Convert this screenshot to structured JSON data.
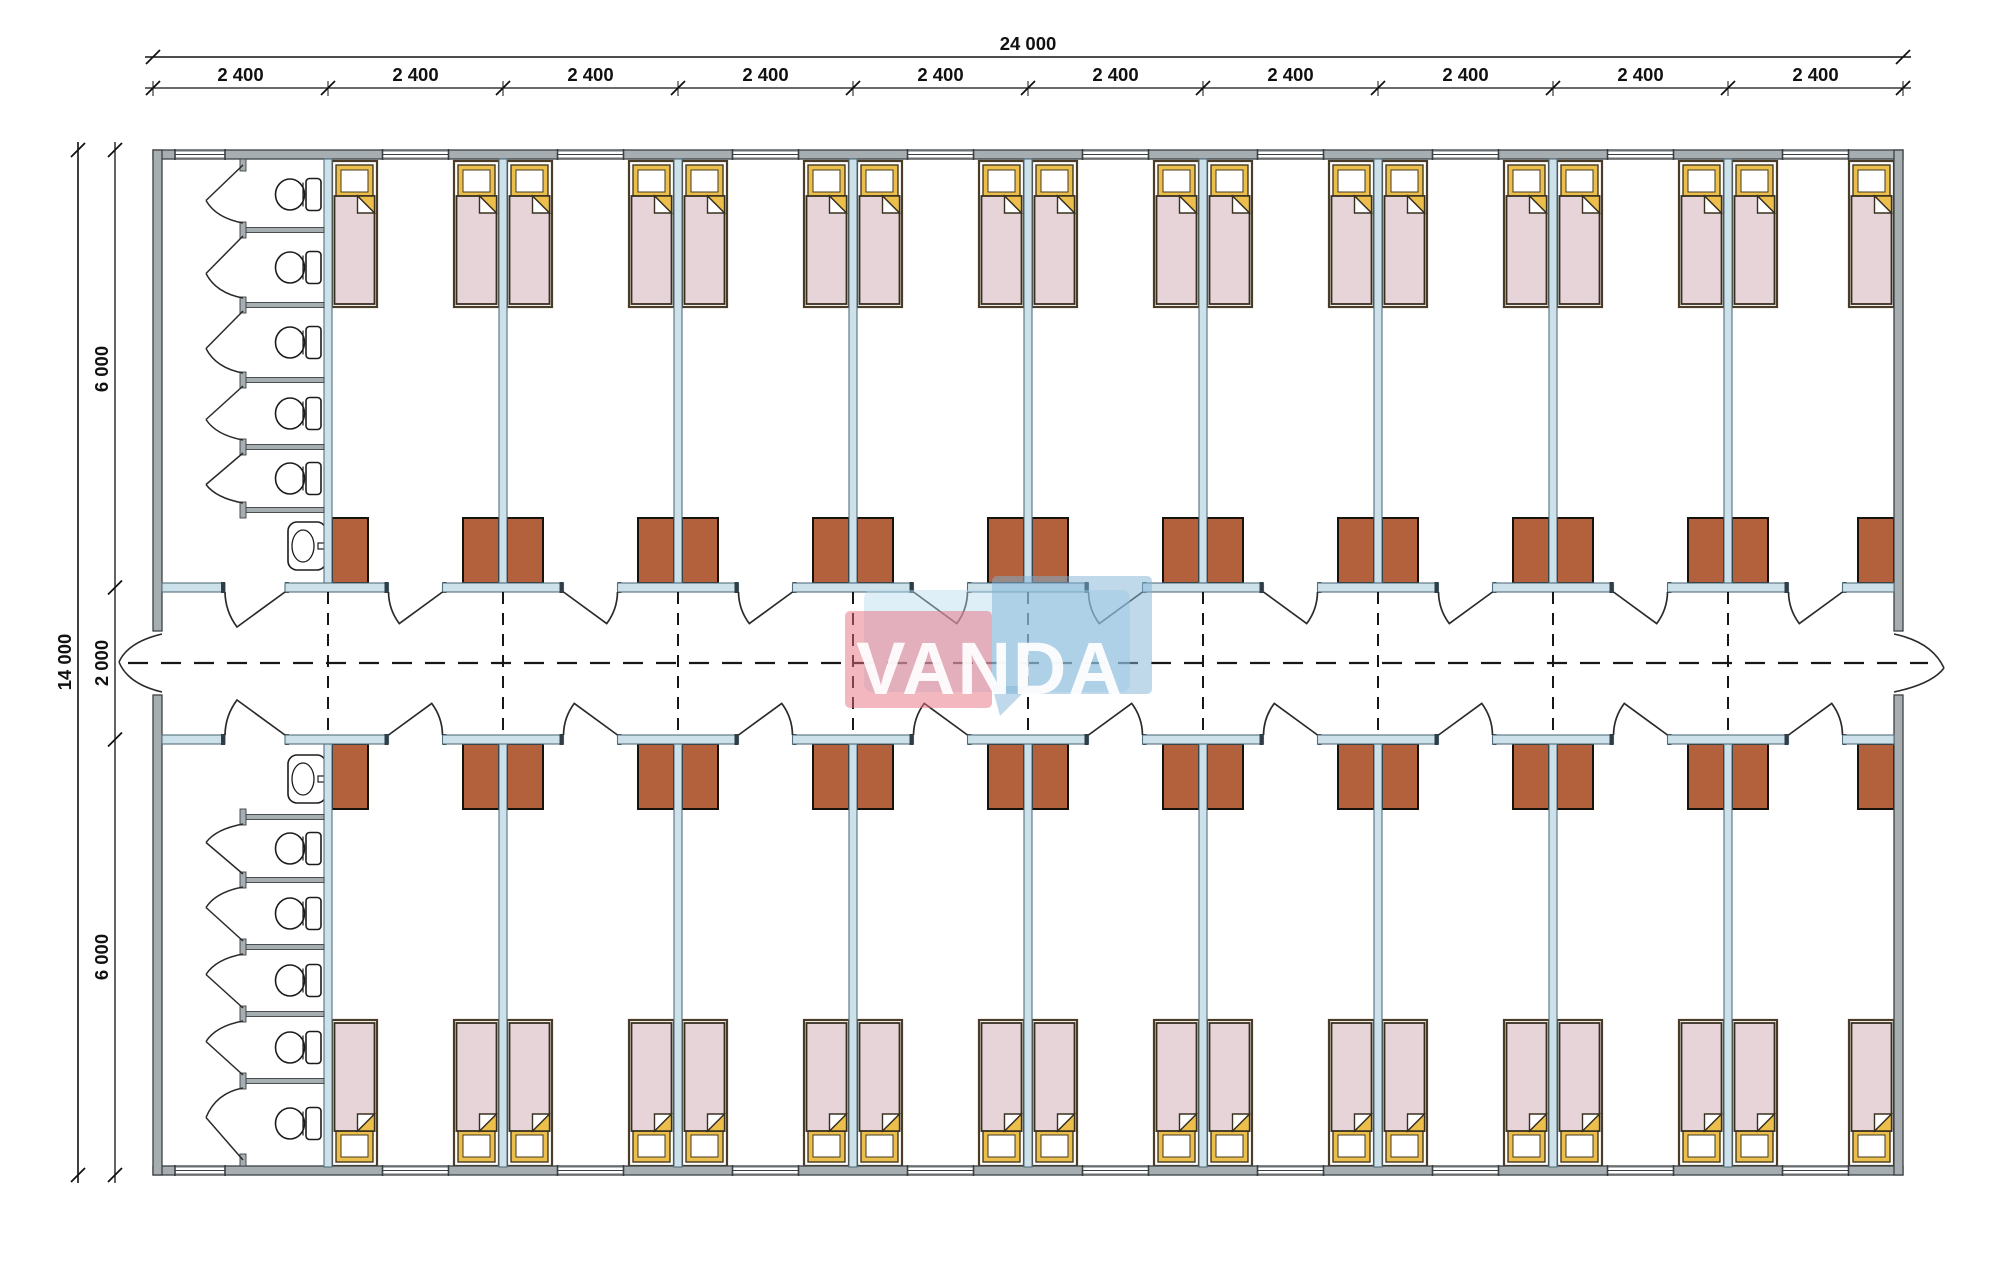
{
  "drawing_type": "dormitory-floor-plan",
  "dimensions": {
    "top": {
      "overall": "24 000",
      "segment": "2 400",
      "segment_count": 10
    },
    "left": {
      "overall": "14 000",
      "top": "6 000",
      "middle": "2 000",
      "bottom": "6 000"
    }
  },
  "plan": {
    "modules": 10,
    "module_width_mm": 2400,
    "building_width_mm": 24000,
    "building_depth_mm": 14000,
    "corridor_width_mm": 2000,
    "wings": 2,
    "rooms_per_wing": 9,
    "beds_per_room": 2,
    "wardrobes_per_room": 2,
    "bathrooms": 2,
    "toilet_stalls_per_bathroom": 5,
    "sinks_per_bathroom": 1
  },
  "watermark": {
    "text": "VANDA",
    "pink": "#e8707f",
    "blue": "#7fb4d8",
    "blue_light": "#b5dcf0"
  },
  "colors": {
    "exterior_wall": "#a7aeb1",
    "exterior_stroke": "#3c4144",
    "partition_wall": "#cde1ea",
    "partition_stroke": "#54707e",
    "cap": "#2f3e46",
    "cabinet": "#b3613c",
    "cabinet_stroke": "#18120c",
    "bed_frame_stroke": "#4a3c26",
    "pillow": "#ecbf4d",
    "pillow_stroke": "#46391f",
    "blanket": "#e6d4d9",
    "blanket_stroke": "#38301f",
    "fixture_stroke": "#1c1c1c",
    "door_stroke": "#2a2a2a",
    "axis": "#161616",
    "dim": "#111111"
  }
}
